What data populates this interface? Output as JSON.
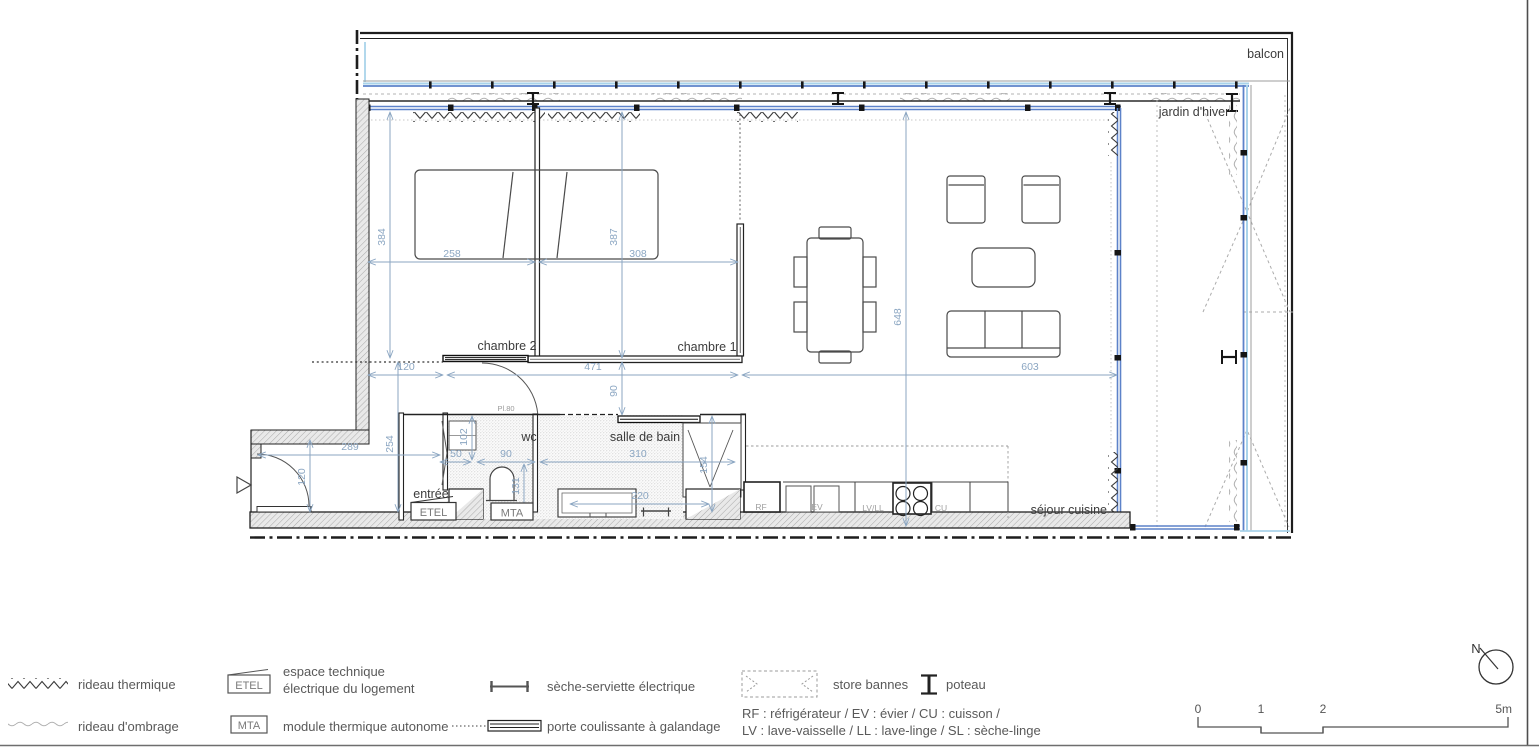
{
  "plan": {
    "labels": {
      "balcon": "balcon",
      "jardin_dhiver": "jardin d'hiver",
      "chambre2": "chambre 2",
      "chambre1": "chambre 1",
      "wc": "wc",
      "salle_de_bain": "salle de bain",
      "entree": "entrée",
      "sejour_cuisine": "séjour cuisine",
      "etel": "ETEL",
      "mta": "MTA",
      "pl80": "Pl.80"
    },
    "appliances": {
      "rf": "RF",
      "ev": "EV",
      "lvll": "LV/LL",
      "cu": "CU"
    },
    "dimensions": {
      "d384": "384",
      "d258": "258",
      "d387": "387",
      "d308": "308",
      "d648": "648",
      "d120_top": "120",
      "d471": "471",
      "d603": "603",
      "d90_couloir": "90",
      "d289": "289",
      "d254": "254",
      "d120_entree": "120",
      "d50": "50",
      "d102": "102",
      "d90_wc": "90",
      "d131": "131",
      "d310": "310",
      "d154": "154",
      "d220": "220"
    },
    "colors": {
      "glazing_blue": "#5d82c9",
      "glazing_light_blue": "#a9d3ea",
      "dimension_blue": "#8ba6c2"
    }
  },
  "legend": {
    "rideau_thermique": "rideau thermique",
    "rideau_ombrage": "rideau d'ombrage",
    "etel_label": "ETEL",
    "etel_desc_line1": "espace technique",
    "etel_desc_line2": "électrique du logement",
    "mta_label": "MTA",
    "mta_desc": "module thermique autonome",
    "seche_serviette": "sèche-serviette électrique",
    "porte_coulissante": "porte coulissante à galandage",
    "store_bannes": "store bannes",
    "poteau": "poteau",
    "abbrev_line1": "RF : réfrigérateur / EV : évier / CU : cuisson /",
    "abbrev_line2": "LV : lave-vaisselle / LL : lave-linge / SL : sèche-linge"
  },
  "scale_bar": {
    "t0": "0",
    "t1": "1",
    "t2": "2",
    "t5": "5m"
  },
  "north_label": "N"
}
